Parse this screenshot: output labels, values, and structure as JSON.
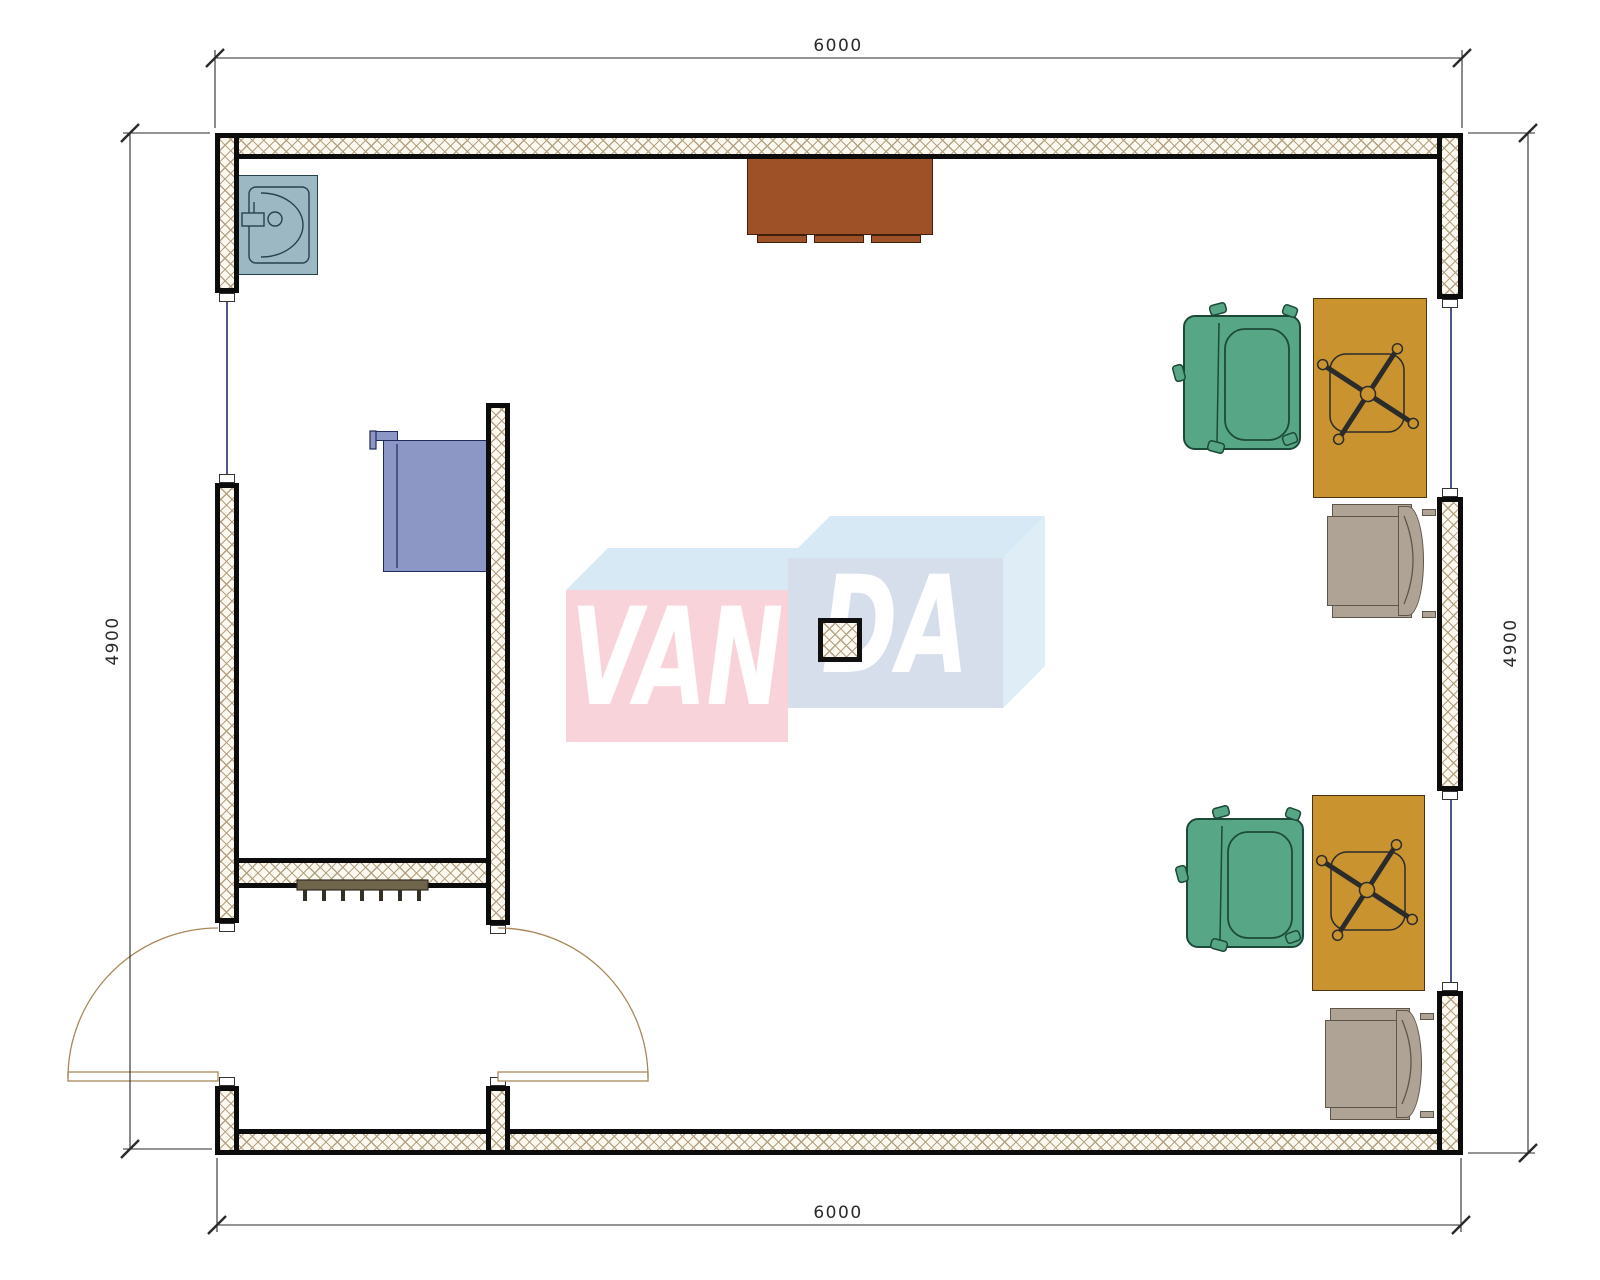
{
  "drawing": {
    "title": "room floor plan",
    "dimensions": {
      "top": "6000",
      "bottom": "6000",
      "left": "4900",
      "right": "4900"
    },
    "watermark": {
      "left_text": "VAN",
      "right_text": "DA"
    },
    "furniture": [
      {
        "name": "sink-unit"
      },
      {
        "name": "appliance-counter"
      },
      {
        "name": "sideboard-cabinet"
      },
      {
        "name": "radiator"
      },
      {
        "name": "structural-column"
      },
      {
        "name": "desk-upper"
      },
      {
        "name": "desk-lower"
      },
      {
        "name": "task-chair-upper"
      },
      {
        "name": "task-chair-lower"
      },
      {
        "name": "armchair-upper"
      },
      {
        "name": "armchair-lower"
      },
      {
        "name": "double-swing-door"
      },
      {
        "name": "window-left"
      },
      {
        "name": "window-right-upper"
      },
      {
        "name": "window-right-lower"
      }
    ],
    "colors": {
      "wall_hatch_line": "#b3a284",
      "wall_fill": "#fcf9f1",
      "wall_border": "#0c0c0c",
      "sink": "#9cb9c3",
      "appliance": "#8d97c5",
      "cabinet": "#9e5126",
      "desk": "#c9942f",
      "task_chair": "#57a786",
      "armchair": "#aea395",
      "radiator": "#6f654b",
      "window_glazing": "#1f2d69",
      "door": "#a8885a",
      "watermark_pink": "#f8d4da",
      "watermark_blue_top": "#d6e9f4",
      "watermark_blue_front": "#d5deea",
      "watermark_blue_side": "#dfedf6",
      "dimension": "#2a2a2a"
    }
  }
}
